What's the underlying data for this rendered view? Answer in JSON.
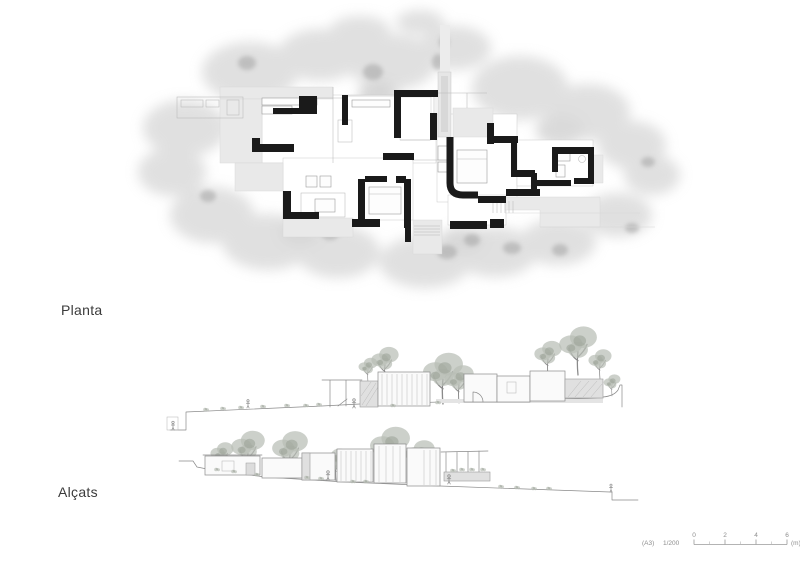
{
  "sheet": {
    "background": "#ffffff",
    "plan_label": "Planta",
    "elevations_label": "Alçats"
  },
  "scale_bar": {
    "sheet_size": "(A3)",
    "scale_ratio": "1/200",
    "ticks": [
      "0",
      "2",
      "4",
      "6"
    ],
    "unit": "(m)"
  },
  "colors": {
    "walls": "#1a1a1a",
    "floor_plates": "#e9e9e9",
    "tree_wash": "#c6c6c6",
    "elevation_linework": "#8a8a8a",
    "label_text": "#3b3b3b",
    "scale_text": "#8d8d8d"
  }
}
